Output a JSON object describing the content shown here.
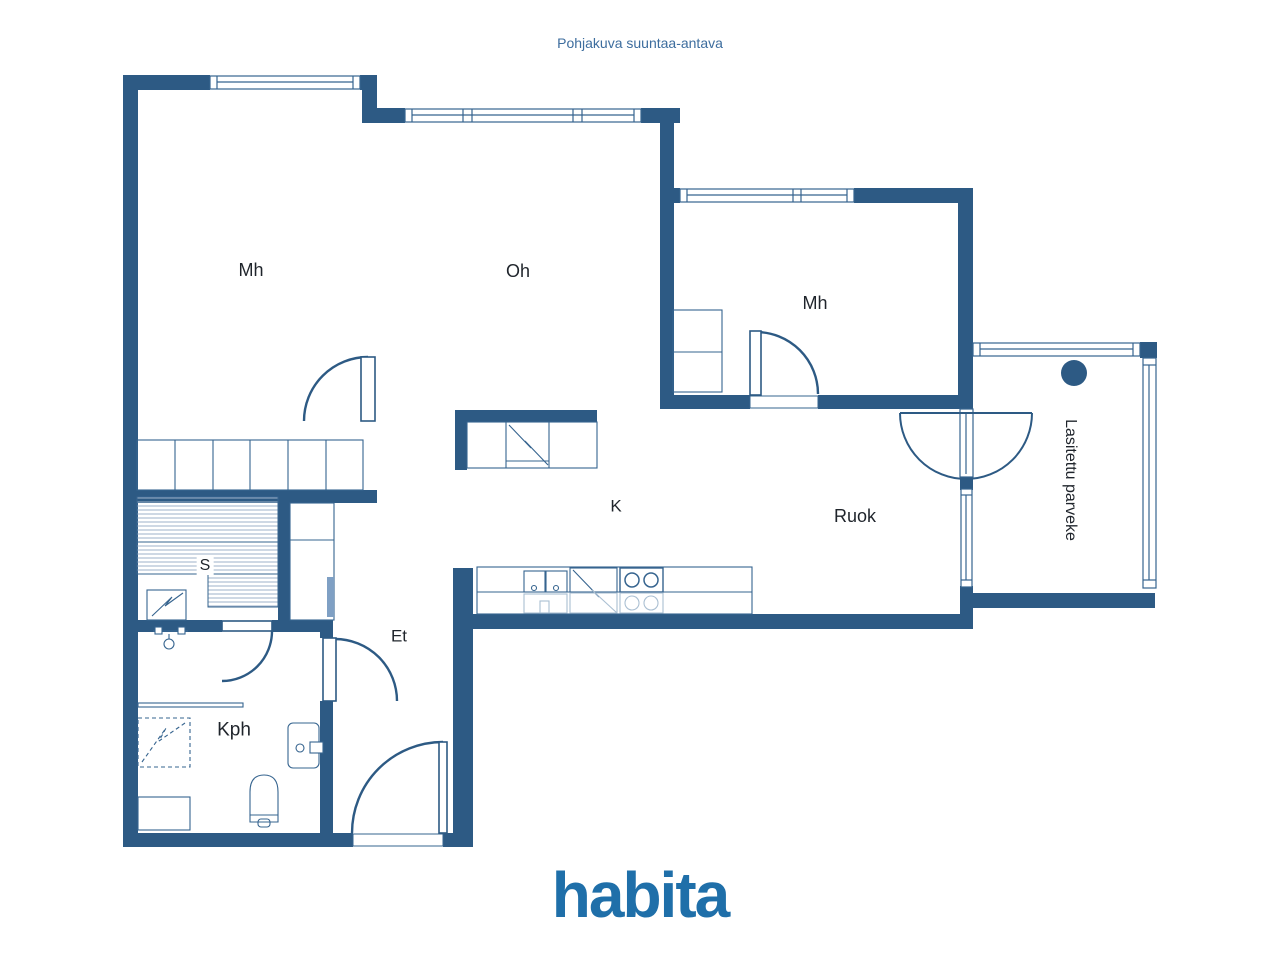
{
  "title": "Pohjakuva suuntaa-antava",
  "logo": "habita",
  "rooms": [
    {
      "id": "mh-left",
      "label": "Mh"
    },
    {
      "id": "oh",
      "label": "Oh"
    },
    {
      "id": "mh-right",
      "label": "Mh"
    },
    {
      "id": "k",
      "label": "K"
    },
    {
      "id": "ruok",
      "label": "Ruok"
    },
    {
      "id": "s",
      "label": "S"
    },
    {
      "id": "et",
      "label": "Et"
    },
    {
      "id": "kph",
      "label": "Kph"
    },
    {
      "id": "parveke",
      "label": "Lasitettu parveke"
    }
  ],
  "colors": {
    "wall": "#2d5a84",
    "line": "#36648f",
    "ghost": "#aabfd2",
    "hatch": "#9db1c8",
    "label": "#1f242b",
    "title": "#3d6d9e",
    "logo": "#1f6fa9"
  }
}
